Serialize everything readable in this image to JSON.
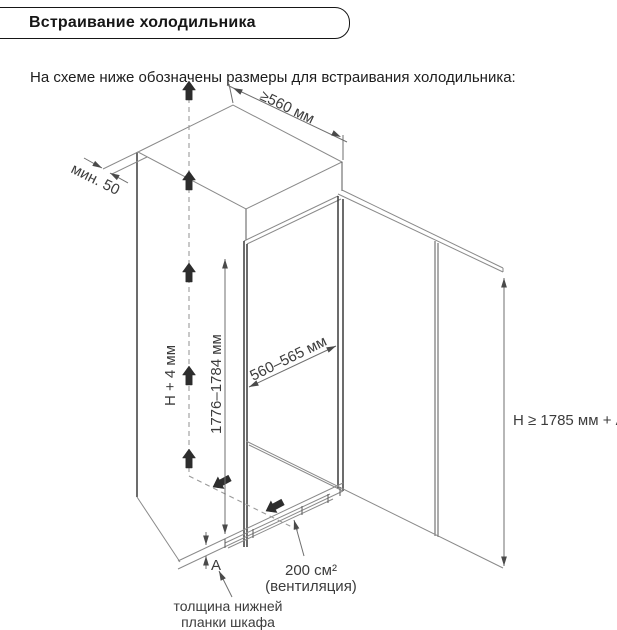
{
  "header": {
    "title": "Встраивание холодильника"
  },
  "intro_text": "На схеме ниже обозначены размеры для встраивания холодильника:",
  "diagram": {
    "labels": {
      "top_depth": "≥560 мм",
      "min_gap": "мин. 50",
      "height_plus_clearance": "H + 4 мм",
      "niche_height": "1776–1784 мм",
      "niche_width": "560–565 мм",
      "total_height": "H ≥ 1785 мм + A",
      "plinth_thickness": "A",
      "vent_area": "200 см²",
      "vent_caption": "(вентиляция)",
      "plinth_note_line1": "толщина нижней",
      "plinth_note_line2": "планки шкафа"
    },
    "colors": {
      "main_edge": "#2e2e2e",
      "construction_line": "#8a8a8a",
      "label_text": "#3c3c3c",
      "airflow_arrow": "#2d2d2d"
    }
  }
}
